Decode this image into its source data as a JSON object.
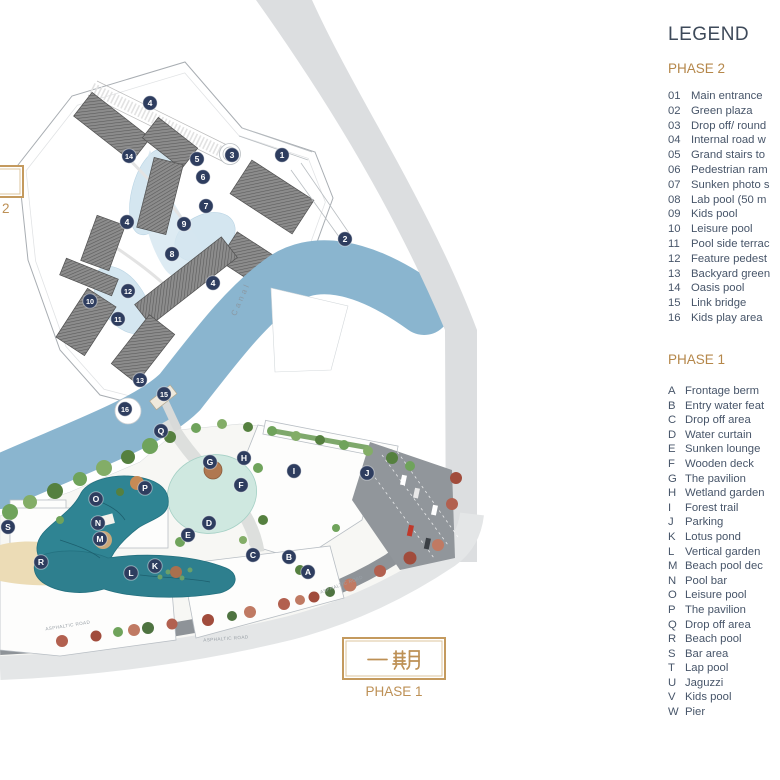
{
  "legend": {
    "title": "LEGEND",
    "phase2": {
      "heading": "PHASE 2",
      "items": [
        {
          "key": "01",
          "label": "Main entrance"
        },
        {
          "key": "02",
          "label": "Green plaza"
        },
        {
          "key": "03",
          "label": "Drop off/ round"
        },
        {
          "key": "04",
          "label": "Internal road w"
        },
        {
          "key": "05",
          "label": "Grand stairs to"
        },
        {
          "key": "06",
          "label": "Pedestrian ram"
        },
        {
          "key": "07",
          "label": "Sunken photo s"
        },
        {
          "key": "08",
          "label": "Lab pool (50 m"
        },
        {
          "key": "09",
          "label": "Kids pool"
        },
        {
          "key": "10",
          "label": "Leisure pool"
        },
        {
          "key": "11",
          "label": "Pool side terrac"
        },
        {
          "key": "12",
          "label": "Feature pedest"
        },
        {
          "key": "13",
          "label": "Backyard green"
        },
        {
          "key": "14",
          "label": "Oasis pool"
        },
        {
          "key": "15",
          "label": "Link bridge"
        },
        {
          "key": "16",
          "label": "Kids play area"
        }
      ]
    },
    "phase1": {
      "heading": "PHASE 1",
      "items": [
        {
          "key": "A",
          "label": "Frontage berm"
        },
        {
          "key": "B",
          "label": "Entry water feat"
        },
        {
          "key": "C",
          "label": "Drop off area"
        },
        {
          "key": "D",
          "label": "Water curtain"
        },
        {
          "key": "E",
          "label": "Sunken lounge"
        },
        {
          "key": "F",
          "label": "Wooden deck"
        },
        {
          "key": "G",
          "label": "The pavilion"
        },
        {
          "key": "H",
          "label": "Wetland garden"
        },
        {
          "key": "I",
          "label": "Forest trail"
        },
        {
          "key": "J",
          "label": "Parking"
        },
        {
          "key": "K",
          "label": "Lotus pond"
        },
        {
          "key": "L",
          "label": "Vertical garden"
        },
        {
          "key": "M",
          "label": "Beach pool dec"
        },
        {
          "key": "N",
          "label": "Pool bar"
        },
        {
          "key": "O",
          "label": "Leisure pool"
        },
        {
          "key": "P",
          "label": "The pavilion"
        },
        {
          "key": "Q",
          "label": "Drop off area"
        },
        {
          "key": "R",
          "label": "Beach pool"
        },
        {
          "key": "S",
          "label": "Bar area"
        },
        {
          "key": "T",
          "label": "Lap pool"
        },
        {
          "key": "U",
          "label": "Jaguzzi"
        },
        {
          "key": "V",
          "label": "Kids pool"
        },
        {
          "key": "W",
          "label": "Pier"
        }
      ]
    }
  },
  "map": {
    "phase1_label": {
      "chinese": "一期",
      "caption": "PHASE 1"
    },
    "phase2_label": {
      "caption": "PHASE 2"
    },
    "canal_label": "Canal",
    "road_labels": [
      {
        "text": "Canal",
        "x": 243,
        "y": 300,
        "rot": -66,
        "size": 8,
        "spacing": 3,
        "color": "#8b99a4"
      },
      {
        "text": "ASPHALTIC ROAD",
        "x": 68,
        "y": 627,
        "rot": -9,
        "size": 4.6,
        "spacing": 0.4,
        "color": "#9aa1a7"
      },
      {
        "text": "ASPHALTIC ROAD",
        "x": 226,
        "y": 640,
        "rot": -4,
        "size": 4.6,
        "spacing": 0.4,
        "color": "#9aa1a7"
      },
      {
        "text": "ASPHALTIC ROAD",
        "x": 342,
        "y": 586,
        "rot": -20,
        "size": 4.6,
        "spacing": 0.4,
        "color": "#9aa1a7"
      }
    ],
    "phase2_markers": [
      {
        "n": "1",
        "x": 282,
        "y": 155
      },
      {
        "n": "2",
        "x": 345,
        "y": 239
      },
      {
        "n": "3",
        "x": 232,
        "y": 155
      },
      {
        "n": "4",
        "x": 150,
        "y": 103
      },
      {
        "n": "4",
        "x": 127,
        "y": 222
      },
      {
        "n": "4",
        "x": 213,
        "y": 283
      },
      {
        "n": "5",
        "x": 197,
        "y": 159
      },
      {
        "n": "6",
        "x": 203,
        "y": 177
      },
      {
        "n": "7",
        "x": 206,
        "y": 206
      },
      {
        "n": "8",
        "x": 172,
        "y": 254
      },
      {
        "n": "9",
        "x": 184,
        "y": 224
      },
      {
        "n": "10",
        "x": 90,
        "y": 301
      },
      {
        "n": "11",
        "x": 118,
        "y": 319
      },
      {
        "n": "12",
        "x": 128,
        "y": 291
      },
      {
        "n": "13",
        "x": 140,
        "y": 380
      },
      {
        "n": "14",
        "x": 129,
        "y": 156
      },
      {
        "n": "15",
        "x": 164,
        "y": 394
      },
      {
        "n": "16",
        "x": 125,
        "y": 409
      }
    ],
    "phase1_markers": [
      {
        "n": "A",
        "x": 308,
        "y": 572
      },
      {
        "n": "B",
        "x": 289,
        "y": 557
      },
      {
        "n": "C",
        "x": 253,
        "y": 555
      },
      {
        "n": "D",
        "x": 209,
        "y": 523
      },
      {
        "n": "E",
        "x": 188,
        "y": 535
      },
      {
        "n": "F",
        "x": 241,
        "y": 485
      },
      {
        "n": "G",
        "x": 210,
        "y": 462
      },
      {
        "n": "H",
        "x": 244,
        "y": 458
      },
      {
        "n": "I",
        "x": 294,
        "y": 471
      },
      {
        "n": "J",
        "x": 367,
        "y": 473
      },
      {
        "n": "K",
        "x": 155,
        "y": 566
      },
      {
        "n": "L",
        "x": 131,
        "y": 573
      },
      {
        "n": "M",
        "x": 100,
        "y": 539
      },
      {
        "n": "N",
        "x": 98,
        "y": 523
      },
      {
        "n": "O",
        "x": 96,
        "y": 499
      },
      {
        "n": "P",
        "x": 145,
        "y": 488
      },
      {
        "n": "Q",
        "x": 161,
        "y": 431
      },
      {
        "n": "R",
        "x": 41,
        "y": 562
      },
      {
        "n": "S",
        "x": 8,
        "y": 527
      }
    ]
  },
  "colors": {
    "accent_gold": "#b5874a",
    "box_gold": "#c49a5e",
    "legend_text": "#475569",
    "marker_navy": "#2e3d5f",
    "canal_blue": "#8ab5cf",
    "highway_gray": "#dcdee0",
    "pool_teal": "#2f8493",
    "wetland_mint": "#cfe8e0",
    "sand": "#ecdcb6",
    "asphalt": "#8e9398"
  }
}
